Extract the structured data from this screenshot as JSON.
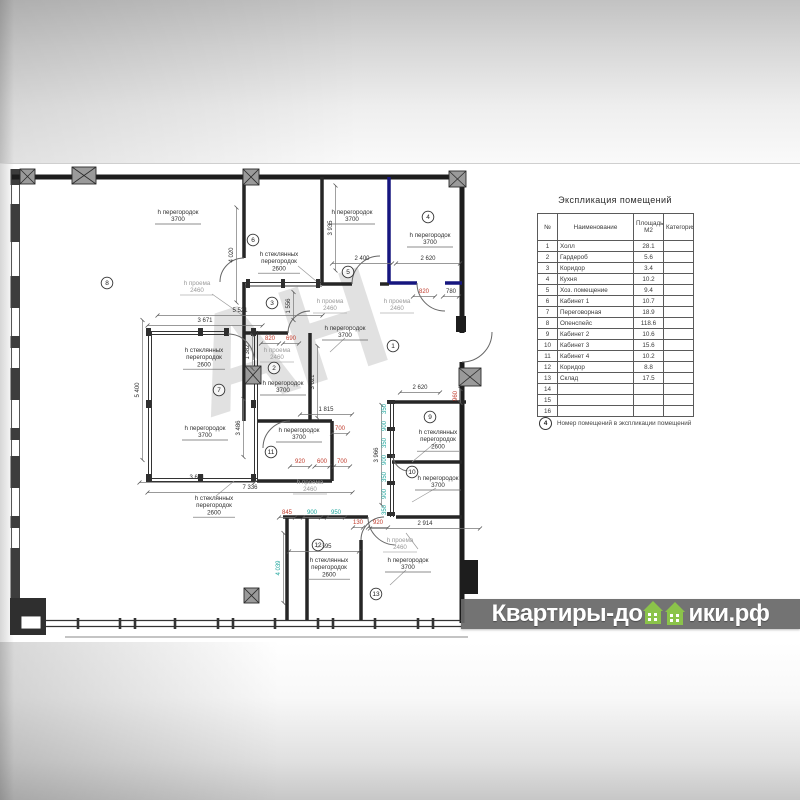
{
  "title": "Экспликация помещений",
  "table": {
    "headers": [
      "№",
      "Наименование",
      "Площадь М2",
      "Категория"
    ],
    "rows": [
      [
        "1",
        "Холл",
        "28.1",
        ""
      ],
      [
        "2",
        "Гардероб",
        "5.6",
        ""
      ],
      [
        "3",
        "Коридор",
        "3.4",
        ""
      ],
      [
        "4",
        "Кухня",
        "10.2",
        ""
      ],
      [
        "5",
        "Хоз. помещение",
        "9.4",
        ""
      ],
      [
        "6",
        "Кабинет 1",
        "10.7",
        ""
      ],
      [
        "7",
        "Переговорная",
        "18.9",
        ""
      ],
      [
        "8",
        "Опенспейс",
        "118.6",
        ""
      ],
      [
        "9",
        "Кабинет 2",
        "10.6",
        ""
      ],
      [
        "10",
        "Кабинет 3",
        "15.6",
        ""
      ],
      [
        "11",
        "Кабинет 4",
        "10.2",
        ""
      ],
      [
        "12",
        "Коридор",
        "8.8",
        ""
      ],
      [
        "13",
        "Склад",
        "17.5",
        ""
      ],
      [
        "14",
        "",
        "",
        ""
      ],
      [
        "15",
        "",
        "",
        ""
      ],
      [
        "16",
        "",
        "",
        ""
      ]
    ]
  },
  "footnote": {
    "symbol": "4",
    "text": "Номер помещений в экспликации помещений"
  },
  "brand": {
    "prefix": "Квартиры-до",
    "suffix": "ики.рф"
  },
  "watermark_center": "АН",
  "colors": {
    "wall": "#1d1d1d",
    "new_partition": "#16167f",
    "dim_black": "#2f2f2f",
    "dim_gray": "#9a9a9a",
    "dim_red": "#bf3a2b",
    "dim_teal": "#1fa59c",
    "brand_green": "#8bc34a",
    "brand_band": "#6a6a6a"
  },
  "plan": {
    "labels": [
      {
        "l": [
          "h перегородок",
          "3700"
        ],
        "x": 178,
        "y": 214,
        "c": "k",
        "ul": 46
      },
      {
        "l": [
          "h перегородок",
          "3700"
        ],
        "x": 352,
        "y": 214,
        "c": "k",
        "ul": 46
      },
      {
        "l": [
          "h перегородок",
          "3700"
        ],
        "x": 430,
        "y": 237,
        "c": "k",
        "ul": 46
      },
      {
        "l": [
          "h стеклянных",
          "перегородок",
          "2600"
        ],
        "x": 279,
        "y": 256,
        "c": "k",
        "ul": 42
      },
      {
        "l": [
          "h проема",
          "2460"
        ],
        "x": 197,
        "y": 285,
        "c": "g",
        "ul": 34
      },
      {
        "l": [
          "h проема",
          "2460"
        ],
        "x": 330,
        "y": 303,
        "c": "g",
        "ul": 34
      },
      {
        "l": [
          "h проема",
          "2460"
        ],
        "x": 397,
        "y": 303,
        "c": "g",
        "ul": 34
      },
      {
        "l": [
          "h перегородок",
          "3700"
        ],
        "x": 345,
        "y": 330,
        "c": "k",
        "ul": 46
      },
      {
        "l": [
          "h проема",
          "2460"
        ],
        "x": 277,
        "y": 352,
        "c": "g",
        "ul": 34
      },
      {
        "l": [
          "h стеклянных",
          "перегородок",
          "2600"
        ],
        "x": 204,
        "y": 352,
        "c": "k",
        "ul": 42
      },
      {
        "l": [
          "h перегородок",
          "3700"
        ],
        "x": 283,
        "y": 385,
        "c": "k",
        "ul": 46
      },
      {
        "l": [
          "h перегородок",
          "3700"
        ],
        "x": 205,
        "y": 430,
        "c": "k",
        "ul": 46
      },
      {
        "l": [
          "h перегородок",
          "3700"
        ],
        "x": 299,
        "y": 432,
        "c": "k",
        "ul": 46
      },
      {
        "l": [
          "h проема",
          "2460"
        ],
        "x": 310,
        "y": 484,
        "c": "g",
        "ul": 34
      },
      {
        "l": [
          "h стеклянных",
          "перегородок",
          "2600"
        ],
        "x": 214,
        "y": 500,
        "c": "k",
        "ul": 42
      },
      {
        "l": [
          "h стеклянных",
          "перегородок",
          "2600"
        ],
        "x": 438,
        "y": 434,
        "c": "k",
        "ul": 42
      },
      {
        "l": [
          "h перегородок",
          "3700"
        ],
        "x": 438,
        "y": 480,
        "c": "k",
        "ul": 46
      },
      {
        "l": [
          "h проема",
          "2460"
        ],
        "x": 400,
        "y": 542,
        "c": "g",
        "ul": 34
      },
      {
        "l": [
          "h стеклянных",
          "перегородок",
          "2600"
        ],
        "x": 329,
        "y": 562,
        "c": "k",
        "ul": 42
      },
      {
        "l": [
          "h перегородок",
          "3700"
        ],
        "x": 408,
        "y": 562,
        "c": "k",
        "ul": 46
      },
      {
        "l": [
          "4 020"
        ],
        "x": 233,
        "y": 255,
        "c": "k",
        "rot": 1,
        "dim": 95
      },
      {
        "l": [
          "2 400"
        ],
        "x": 362,
        "y": 260,
        "c": "k",
        "dim": 60
      },
      {
        "l": [
          "2 620"
        ],
        "x": 428,
        "y": 260,
        "c": "k",
        "dim": 64
      },
      {
        "l": [
          "820"
        ],
        "x": 424,
        "y": 293,
        "c": "r",
        "dim": 22
      },
      {
        "l": [
          "780"
        ],
        "x": 451,
        "y": 293,
        "c": "k",
        "dim": 16
      },
      {
        "l": [
          "5 521"
        ],
        "x": 240,
        "y": 312,
        "c": "k",
        "dim": 165
      },
      {
        "l": [
          "3 671"
        ],
        "x": 205,
        "y": 322,
        "c": "k",
        "dim": 115
      },
      {
        "l": [
          "1 556"
        ],
        "x": 290,
        "y": 306,
        "c": "k",
        "rot": 1,
        "dim": 28
      },
      {
        "l": [
          "3 935"
        ],
        "x": 332,
        "y": 228,
        "c": "k",
        "rot": 1,
        "dim": 85
      },
      {
        "l": [
          "1 382"
        ],
        "x": 249,
        "y": 352,
        "c": "k",
        "rot": 1,
        "dim": 34
      },
      {
        "l": [
          "820"
        ],
        "x": 270,
        "y": 340,
        "c": "r",
        "dim": 18
      },
      {
        "l": [
          "690"
        ],
        "x": 291,
        "y": 340,
        "c": "r",
        "dim": 16
      },
      {
        "l": [
          "3 621"
        ],
        "x": 314,
        "y": 382,
        "c": "k",
        "rot": 1,
        "dim": 72
      },
      {
        "l": [
          "5 400"
        ],
        "x": 139,
        "y": 390,
        "c": "k",
        "rot": 1,
        "dim": 140
      },
      {
        "l": [
          "3 486"
        ],
        "x": 240,
        "y": 428,
        "c": "k",
        "rot": 1,
        "dim": 58
      },
      {
        "l": [
          "1 815"
        ],
        "x": 326,
        "y": 411,
        "c": "k",
        "dim": 52
      },
      {
        "l": [
          "700"
        ],
        "x": 340,
        "y": 430,
        "c": "r",
        "dim": 16
      },
      {
        "l": [
          "920"
        ],
        "x": 300,
        "y": 463,
        "c": "r",
        "dim": 20
      },
      {
        "l": [
          "600"
        ],
        "x": 322,
        "y": 463,
        "c": "r",
        "dim": 15
      },
      {
        "l": [
          "700"
        ],
        "x": 342,
        "y": 463,
        "c": "r",
        "dim": 16
      },
      {
        "l": [
          "3 671"
        ],
        "x": 197,
        "y": 479,
        "c": "k",
        "dim": 115
      },
      {
        "l": [
          "7 336"
        ],
        "x": 250,
        "y": 489,
        "c": "k",
        "dim": 205
      },
      {
        "l": [
          "3 966"
        ],
        "x": 378,
        "y": 455,
        "c": "k",
        "rot": 1,
        "dim": 100
      },
      {
        "l": [
          "845"
        ],
        "x": 287,
        "y": 514,
        "c": "r",
        "dim": 16
      },
      {
        "l": [
          "900"
        ],
        "x": 312,
        "y": 514,
        "c": "t",
        "dim": 18
      },
      {
        "l": [
          "950"
        ],
        "x": 336,
        "y": 514,
        "c": "t",
        "dim": 18
      },
      {
        "l": [
          "130"
        ],
        "x": 358,
        "y": 524,
        "c": "r",
        "dim": 10
      },
      {
        "l": [
          "920"
        ],
        "x": 378,
        "y": 524,
        "c": "r",
        "dim": 20
      },
      {
        "l": [
          "2 914"
        ],
        "x": 425,
        "y": 525,
        "c": "k",
        "dim": 110
      },
      {
        "l": [
          "2 595"
        ],
        "x": 324,
        "y": 548,
        "c": "k",
        "dim": 70
      },
      {
        "l": [
          "4 039"
        ],
        "x": 280,
        "y": 568,
        "c": "t",
        "rot": 1,
        "dim": 70
      },
      {
        "l": [
          "2 620"
        ],
        "x": 420,
        "y": 389,
        "c": "k",
        "dim": 40
      },
      {
        "l": [
          "960"
        ],
        "x": 457,
        "y": 396,
        "c": "r",
        "rot": 1,
        "dim": 14
      },
      {
        "l": [
          "350"
        ],
        "x": 386,
        "y": 409,
        "c": "t",
        "rot": 1
      },
      {
        "l": [
          "900"
        ],
        "x": 386,
        "y": 426,
        "c": "t",
        "rot": 1
      },
      {
        "l": [
          "350"
        ],
        "x": 386,
        "y": 443,
        "c": "t",
        "rot": 1
      },
      {
        "l": [
          "900"
        ],
        "x": 386,
        "y": 460,
        "c": "t",
        "rot": 1
      },
      {
        "l": [
          "350"
        ],
        "x": 386,
        "y": 477,
        "c": "t",
        "rot": 1
      },
      {
        "l": [
          "900"
        ],
        "x": 386,
        "y": 494,
        "c": "t",
        "rot": 1
      },
      {
        "l": [
          "350"
        ],
        "x": 386,
        "y": 510,
        "c": "t",
        "rot": 1
      }
    ],
    "room_numbers": [
      {
        "n": "1",
        "x": 393,
        "y": 346
      },
      {
        "n": "2",
        "x": 274,
        "y": 368
      },
      {
        "n": "3",
        "x": 272,
        "y": 303
      },
      {
        "n": "4",
        "x": 428,
        "y": 217
      },
      {
        "n": "5",
        "x": 348,
        "y": 272
      },
      {
        "n": "6",
        "x": 253,
        "y": 240
      },
      {
        "n": "7",
        "x": 219,
        "y": 390
      },
      {
        "n": "8",
        "x": 107,
        "y": 283
      },
      {
        "n": "9",
        "x": 430,
        "y": 417
      },
      {
        "n": "10",
        "x": 412,
        "y": 472
      },
      {
        "n": "11",
        "x": 271,
        "y": 452
      },
      {
        "n": "12",
        "x": 318,
        "y": 545
      },
      {
        "n": "13",
        "x": 376,
        "y": 594
      }
    ]
  }
}
